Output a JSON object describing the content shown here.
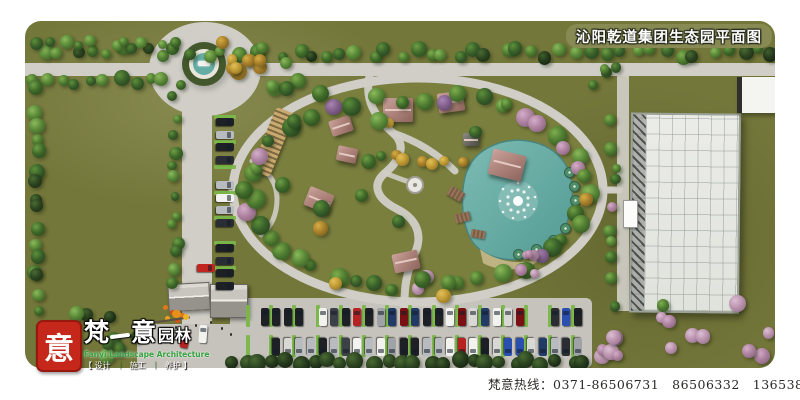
{
  "title_bar": {
    "text": "沁阳乾道集团生态园平面图"
  },
  "logo": {
    "seal_char": "意",
    "brand_cn_1": "梵",
    "brand_cn_2": "意",
    "brand_suffix": "园林",
    "brand_en": "Fanyi Landscape Architecture",
    "bracket_left": "【",
    "bracket_right": "】",
    "separator": "｜",
    "services": [
      "设计",
      "施工",
      "养护"
    ]
  },
  "footer": {
    "hotline": "梵意热线：0371-86506731　86506332　13653862676（孙）"
  },
  "colors": {
    "lawn": "#74773a",
    "lawn_light": "#7e8142",
    "lawn_dark": "#686b32",
    "oval_lawn": "#7a7f3e",
    "road": "#d0cec7",
    "road_dark": "#c6c3bc",
    "water": "#64aca4",
    "water_deep": "#539b93",
    "water_light": "#7cbcb4",
    "beach_sand": "#c6b98c",
    "title_band_bg": "#888a54",
    "seal_red": "#c5271b",
    "brand_green": "#35a33f",
    "parking_stall_green": "#7ab648",
    "roof_pink": "#a87e76",
    "greenhouse_white": "#ebece8",
    "deck_brown": "#8a6a52",
    "umbrella_green": "#4e8f6a",
    "pergola_tan": "#caa96f",
    "hotline_text": "#2d2b28",
    "trees": {
      "green": [
        [
          "#7fae4e",
          "#4f7d31",
          "#2c4a1e"
        ],
        [
          "#6f9f46",
          "#3f6a29",
          "#24401a"
        ],
        [
          "#8cb95c",
          "#5a8a38",
          "#335222"
        ],
        [
          "#5d8f3a",
          "#39602a",
          "#20371a"
        ]
      ],
      "dark": [
        [
          "#4a6b33",
          "#2c4521",
          "#16240f"
        ],
        [
          "#3f5e2c",
          "#24391c",
          "#101b0b"
        ]
      ],
      "yellow": [
        [
          "#e3c05a",
          "#c09a33",
          "#7e6420"
        ],
        [
          "#d8ae46",
          "#a8802a",
          "#6b511c"
        ]
      ],
      "pink": [
        [
          "#dcc0d4",
          "#bb93af",
          "#8a6781"
        ],
        [
          "#d4aec8",
          "#ad82a0",
          "#7c5873"
        ]
      ],
      "purple": [
        [
          "#a985b2",
          "#82608c",
          "#543a5c"
        ]
      ]
    },
    "cars": [
      "#f2f2ef",
      "#f2f2ef",
      "#f2f2ef",
      "#1d2126",
      "#1d2126",
      "#2a2d33",
      "#b8bbbf",
      "#b8bbbf",
      "#9fa3a8",
      "#2a4fae",
      "#223a66",
      "#b62320",
      "#7a1013",
      "#d8d8d4",
      "#3c4148"
    ]
  }
}
